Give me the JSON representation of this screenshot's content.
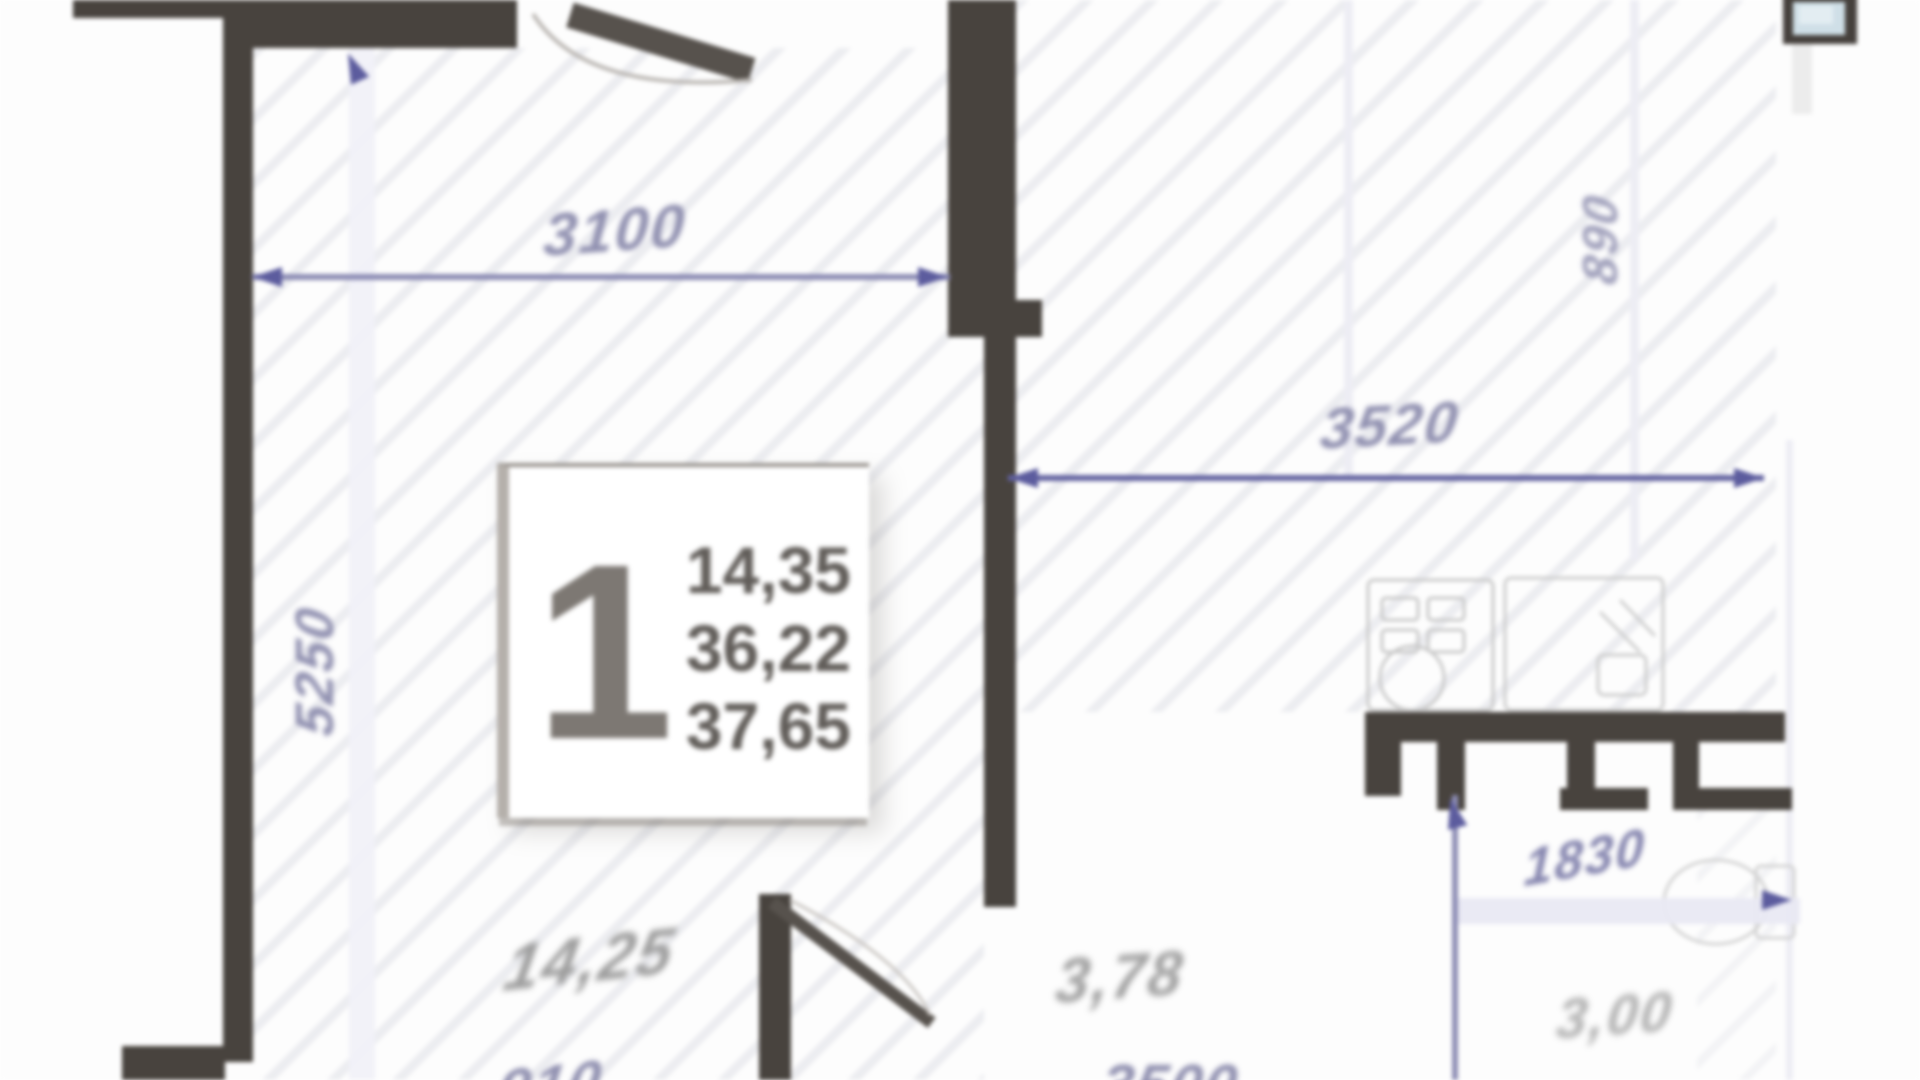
{
  "plan": {
    "title": "apartment-floor-plan",
    "unit_info": {
      "number": "1",
      "areas": [
        "14,35",
        "36,22",
        "37,65"
      ]
    },
    "dimensions": [
      {
        "id": "top-width",
        "value": "3100"
      },
      {
        "id": "left-height",
        "value": "5250"
      },
      {
        "id": "right-width",
        "value": "3520"
      },
      {
        "id": "right-top-height",
        "value": "890"
      },
      {
        "id": "bottom-right-height",
        "value": "1830"
      },
      {
        "id": "bottom-left-partial",
        "value": "910"
      },
      {
        "id": "bottom-center-partial",
        "value": "3500"
      }
    ],
    "room_areas": [
      {
        "id": "living-room",
        "value": "14,25"
      },
      {
        "id": "hallway",
        "value": "3,78"
      },
      {
        "id": "bathroom",
        "value": "3,00"
      }
    ],
    "icons": [
      "vent-icon",
      "stove-icon",
      "kitchen-sink-icon",
      "toilet-icon",
      "door-arc-icon"
    ],
    "colors": {
      "wall": "#48433e",
      "dimension_accent": "#5c5c9e",
      "dimension_text": "#9090b0",
      "area_text": "#9c9c9c",
      "vent_fill": "#cfdfe7",
      "hatch": "#a8acbe"
    }
  }
}
